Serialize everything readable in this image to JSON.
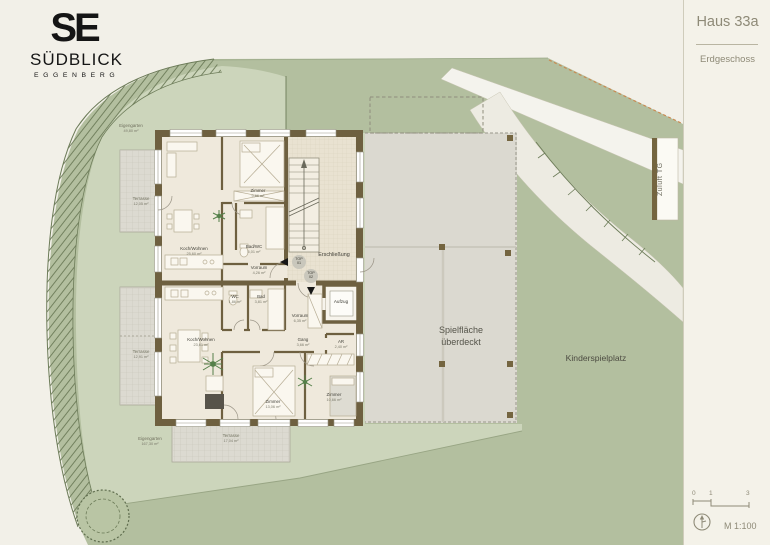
{
  "logo": {
    "monogram": "SE",
    "title": "SÜDBLICK",
    "subtitle": "EGGENBERG"
  },
  "titleblock": {
    "title": "Haus 33a",
    "floor": "Erdgeschoss",
    "scale": "M 1:100",
    "scale_ticks": [
      "0",
      "1",
      "3"
    ],
    "north_icon": "north-arrow"
  },
  "site": {
    "playground_label": "Kinderspielplatz",
    "covered_play_area": {
      "line1": "Spielfläche",
      "line2": "überdeckt"
    },
    "garage_vent_label": "Zuluft TG",
    "gardens": [
      {
        "name": "Eigengarten",
        "area": "49,80 m²"
      },
      {
        "name": "Eigengarten",
        "area": "167,30 m²"
      }
    ],
    "terraces": [
      {
        "name": "Terrasse",
        "area": "12,05 m²"
      },
      {
        "name": "Terrasse",
        "area": "12,91 m²"
      },
      {
        "name": "Terrasse",
        "area": "17,04 m²"
      }
    ]
  },
  "building": {
    "circulation_label": "Erschließung",
    "elevator_label": "Aufzug",
    "unit_badges": [
      {
        "top": "TOP",
        "num": "01"
      },
      {
        "top": "TOP",
        "num": "02"
      }
    ],
    "top01": {
      "rooms": [
        {
          "name": "Koch/Wohnen",
          "area": "25,60 m²"
        },
        {
          "name": "Zimmer",
          "area": "9,66 m²"
        },
        {
          "name": "Bad/WC",
          "area": "5,01 m²"
        },
        {
          "name": "Vorraum",
          "area": "4,26 m²"
        }
      ]
    },
    "top02": {
      "rooms": [
        {
          "name": "Koch/Wohnen",
          "area": "23,61 m²"
        },
        {
          "name": "WC",
          "area": "1,86 m²"
        },
        {
          "name": "Bad",
          "area": "3,81 m²"
        },
        {
          "name": "Vorraum",
          "area": "6,35 m²"
        },
        {
          "name": "Gang",
          "area": "3,66 m²"
        },
        {
          "name": "AR",
          "area": "2,40 m²"
        },
        {
          "name": "Zimmer",
          "area": "13,06 m²"
        },
        {
          "name": "Zimmer",
          "area": "10,66 m²"
        }
      ]
    }
  },
  "colors": {
    "site_green": "#b3bf9f",
    "garden_green": "#ccd5bb",
    "wall_brown": "#6e6040",
    "paper": "#f2f0e8",
    "covered_gray": "#dbd9d0",
    "boundary_dash_orange": "#c98a52"
  }
}
